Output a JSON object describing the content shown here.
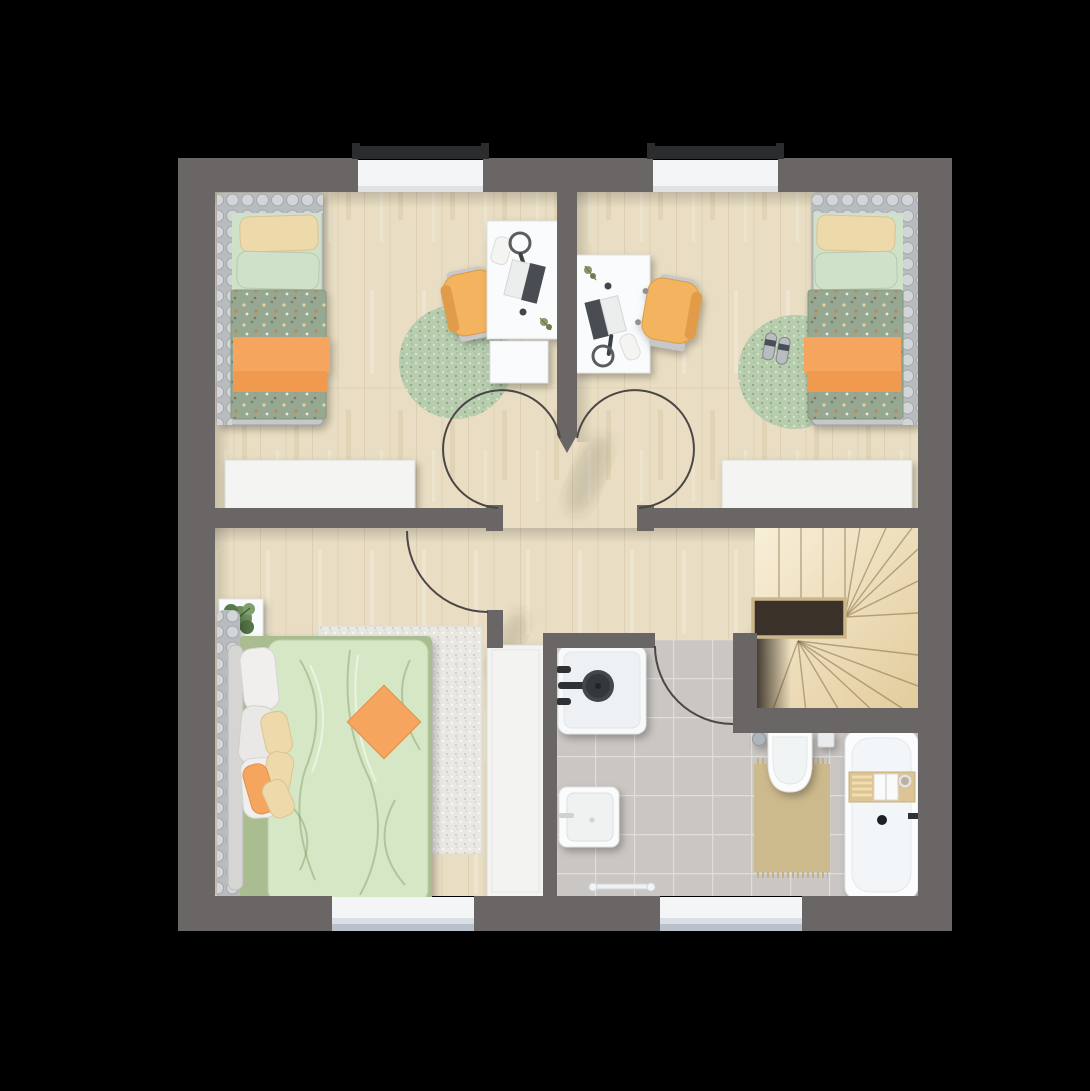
{
  "scene": {
    "type": "floor-plan",
    "view": "top-down-3d-render",
    "background": "#000000",
    "floor_label": ""
  },
  "colors": {
    "wall": "#6a6665",
    "wallDark": "#57534f",
    "wood": "#e9dec3",
    "tile": "#cac6c3",
    "grout": "#e0ddda",
    "duvetSage": "#97a892",
    "duvetSeam": "#76876c",
    "rugGreen": "#b7cdae",
    "rugGray": "#eae8e2",
    "orange": "#f6a55f",
    "orangeDeep": "#ef9a50",
    "mint": "#d0e1c9",
    "cream": "#eed9ab",
    "chairYellow": "#f4b35e",
    "chairTrim": "#d99a42",
    "frameGray": "#b9bcbf",
    "knobGray": "#d3d6d8",
    "white": "#fafbfc",
    "whiteEdge": "#e0e2e2",
    "bedBaseGreen": "#a9bd90",
    "duvetLight": "#d6e7c5",
    "matTan": "#ccb98c",
    "stairLight": "#f8efd9",
    "stairTan": "#e2cc9c",
    "stairLine": "#7d6437",
    "void": "#3a3128",
    "voidTrim": "#c9b68b",
    "arcStroke": "#4b4745",
    "lintel": "#2b2c2e",
    "sill": "#f3f5f6"
  },
  "rooms": [
    {
      "id": "bedroom-top-left",
      "furniture": [
        "single-bed",
        "cream-pillow",
        "mint-pillow",
        "dotted-duvet",
        "orange-blanket",
        "round-rug",
        "desk",
        "desk-chair",
        "drawer-unit",
        "laptop",
        "headphones",
        "dresser",
        "window-top"
      ]
    },
    {
      "id": "bedroom-top-right",
      "furniture": [
        "single-bed",
        "cream-pillow",
        "mint-pillow",
        "dotted-duvet",
        "orange-blanket",
        "round-rug",
        "slippers",
        "desk",
        "desk-chair",
        "laptop",
        "headphones",
        "dresser",
        "window-top"
      ]
    },
    {
      "id": "hallway",
      "furniture": [
        "door-arc-left-bedroom",
        "door-arc-right-bedroom"
      ]
    },
    {
      "id": "master-bedroom",
      "furniture": [
        "double-bed",
        "headboard",
        "pillows",
        "orange-accent-pillow",
        "area-rug",
        "nightstand-with-plant",
        "nightstand-with-speaker",
        "wardrobe",
        "door-arc",
        "window-bottom"
      ]
    },
    {
      "id": "bathroom",
      "furniture": [
        "shower",
        "rain-shower-head",
        "washbasin",
        "towel-rail",
        "wall-hung-toilet",
        "flush-plate",
        "toilet-brush",
        "bath-mat",
        "bathtub",
        "bath-caddy",
        "door-arc",
        "window-bottom"
      ]
    },
    {
      "id": "staircase",
      "furniture": [
        "winder-stairs",
        "stairwell-void"
      ]
    }
  ],
  "windows": {
    "top": 2,
    "bottom": 2
  },
  "doors": {
    "interior_swing": 4
  }
}
